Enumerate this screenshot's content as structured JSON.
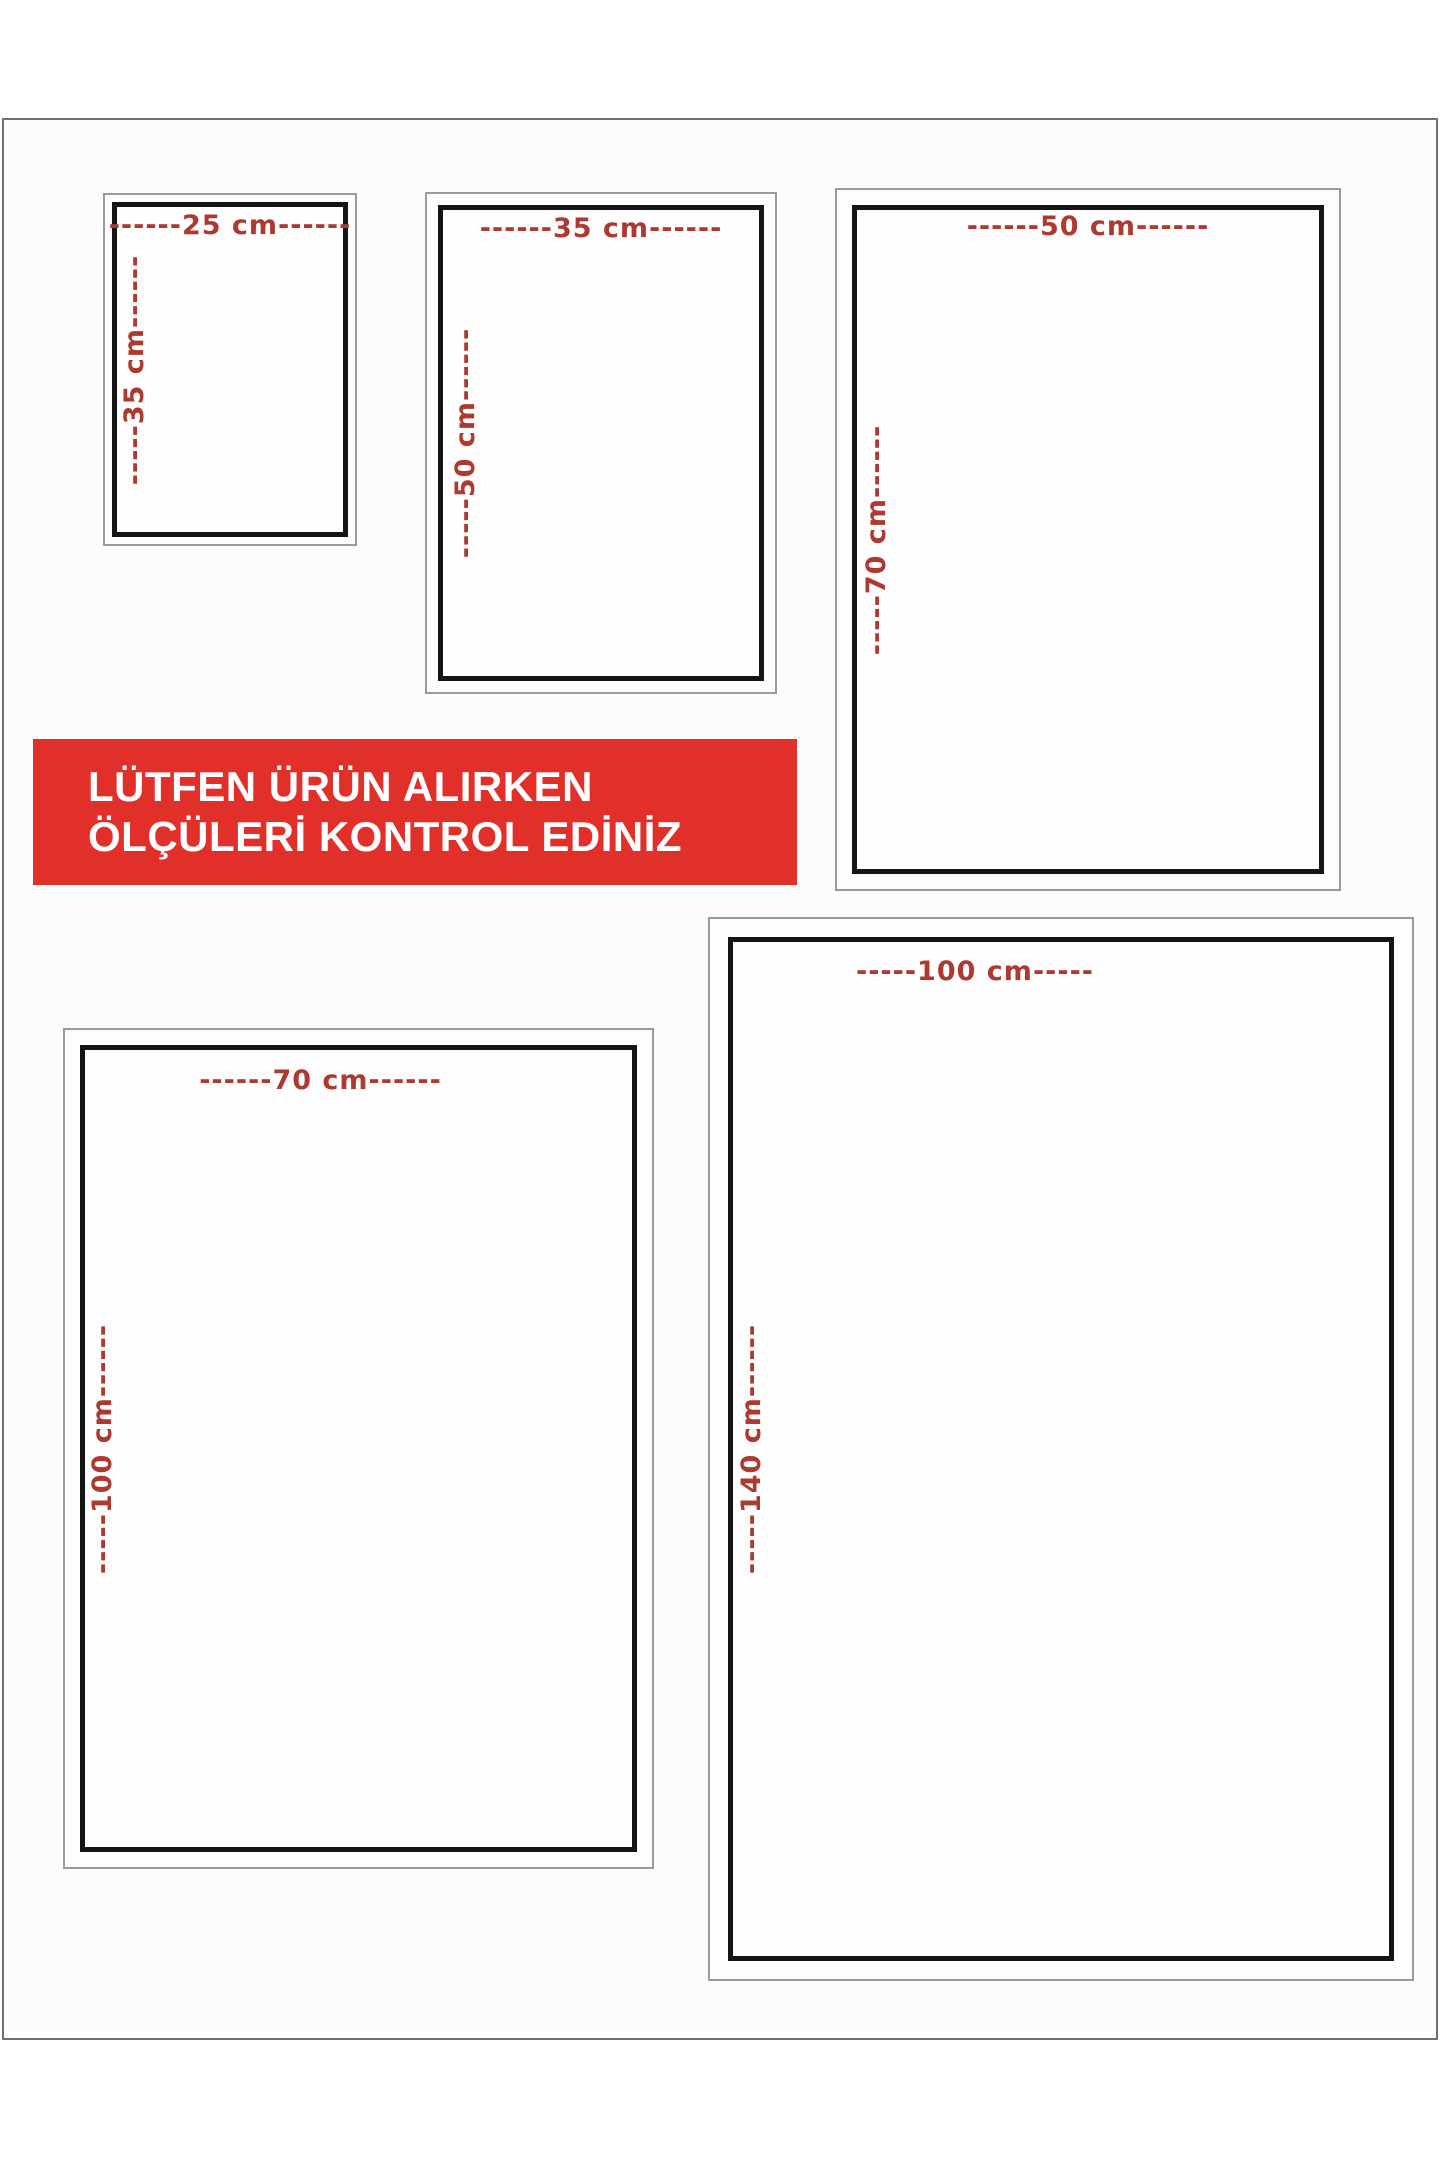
{
  "banner": {
    "line1": "LÜTFEN ÜRÜN ALIRKEN",
    "line2": "ÖLÇÜLERİ KONTROL EDİNİZ",
    "background": "#e1302a",
    "text_color": "#ffffff"
  },
  "colors": {
    "dimension_label": "#ad3a31",
    "box_border": "#151515",
    "outer_frame": "#9a9a9a",
    "page_border": "#6f6f6f",
    "page_background": "#fcfcfc"
  },
  "boxes": [
    {
      "id": "25x35",
      "width_cm": 25,
      "height_cm": 35,
      "width_label": "------25 cm------",
      "height_label": "-----35 cm------"
    },
    {
      "id": "35x50",
      "width_cm": 35,
      "height_cm": 50,
      "width_label": "------35 cm------",
      "height_label": "-----50 cm------"
    },
    {
      "id": "50x70",
      "width_cm": 50,
      "height_cm": 70,
      "width_label": "------50 cm------",
      "height_label": "-----70 cm------"
    },
    {
      "id": "70x100",
      "width_cm": 70,
      "height_cm": 100,
      "width_label": "------70 cm------",
      "height_label": "-----100 cm------"
    },
    {
      "id": "100x140",
      "width_cm": 100,
      "height_cm": 140,
      "width_label": "-----100 cm-----",
      "height_label": "-----140 cm------"
    }
  ]
}
